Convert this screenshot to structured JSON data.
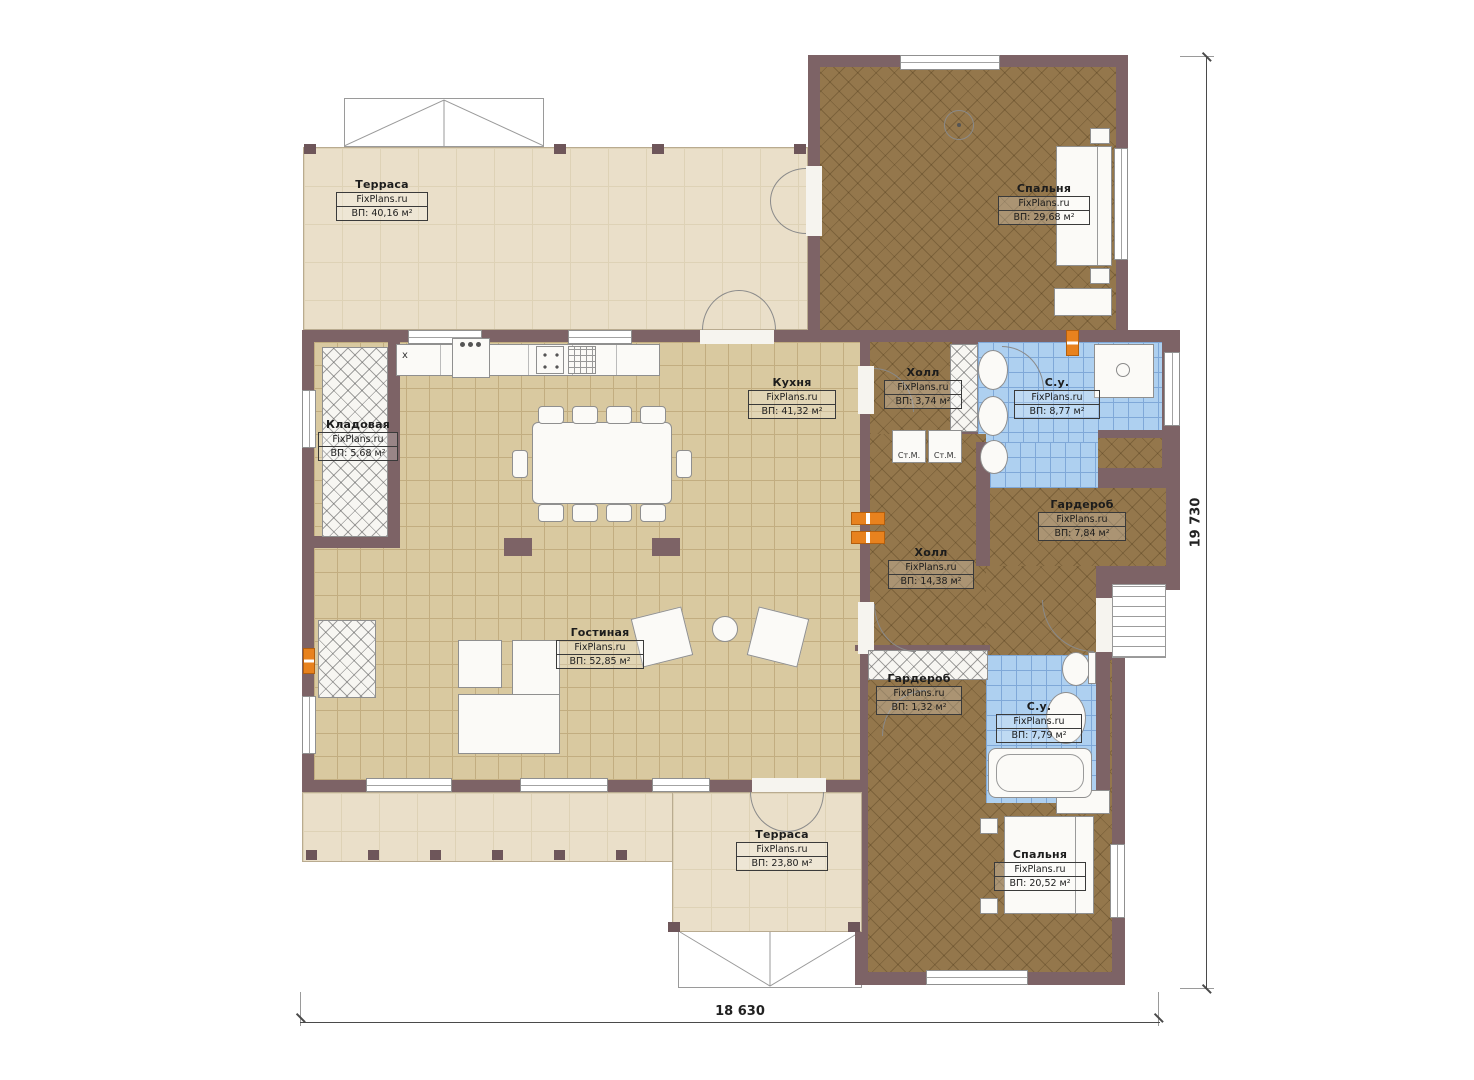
{
  "plan": {
    "rooms": [
      {
        "id": "terrace-top",
        "name": "Терраса",
        "brand": "FixPlans.ru",
        "area": "ВП: 40,16 м²"
      },
      {
        "id": "bedroom-top",
        "name": "Спальня",
        "brand": "FixPlans.ru",
        "area": "ВП: 29,68 м²"
      },
      {
        "id": "storage",
        "name": "Кладовая",
        "brand": "FixPlans.ru",
        "area": "ВП: 5,68 м²"
      },
      {
        "id": "kitchen",
        "name": "Кухня",
        "brand": "FixPlans.ru",
        "area": "ВП: 41,32 м²"
      },
      {
        "id": "hall-top",
        "name": "Холл",
        "brand": "FixPlans.ru",
        "area": "ВП: 3,74 м²"
      },
      {
        "id": "bathroom-top",
        "name": "С.у.",
        "brand": "FixPlans.ru",
        "area": "ВП: 8,77 м²"
      },
      {
        "id": "wardrobe",
        "name": "Гардероб",
        "brand": "FixPlans.ru",
        "area": "ВП: 7,84 м²"
      },
      {
        "id": "hall-main",
        "name": "Холл",
        "brand": "FixPlans.ru",
        "area": "ВП: 14,38 м²"
      },
      {
        "id": "living-room",
        "name": "Гостиная",
        "brand": "FixPlans.ru",
        "area": "ВП: 52,85 м²"
      },
      {
        "id": "wardrobe-small",
        "name": "Гардероб",
        "brand": "FixPlans.ru",
        "area": "ВП: 1,32 м²"
      },
      {
        "id": "bathroom-bottom",
        "name": "С.у.",
        "brand": "FixPlans.ru",
        "area": "ВП: 7,79 м²"
      },
      {
        "id": "terrace-bottom",
        "name": "Терраса",
        "brand": "FixPlans.ru",
        "area": "ВП: 23,80 м²"
      },
      {
        "id": "bedroom-bottom",
        "name": "Спальня",
        "brand": "FixPlans.ru",
        "area": "ВП: 20,52 м²"
      }
    ],
    "appliances": {
      "washer_left": "Ст.М.",
      "washer_right": "Ст.М."
    },
    "kitchen_marks": {
      "x_mark": "x"
    },
    "dimensions": {
      "width": "18 630",
      "height": "19 730"
    },
    "colors": {
      "wall": "#7d6366",
      "tile_floor": "#d9c9a0",
      "wood_floor": "#94774c",
      "bathroom_floor": "#aed0f0",
      "terrace_floor": "#eadfc9",
      "heater_accent": "#e8821e"
    }
  }
}
